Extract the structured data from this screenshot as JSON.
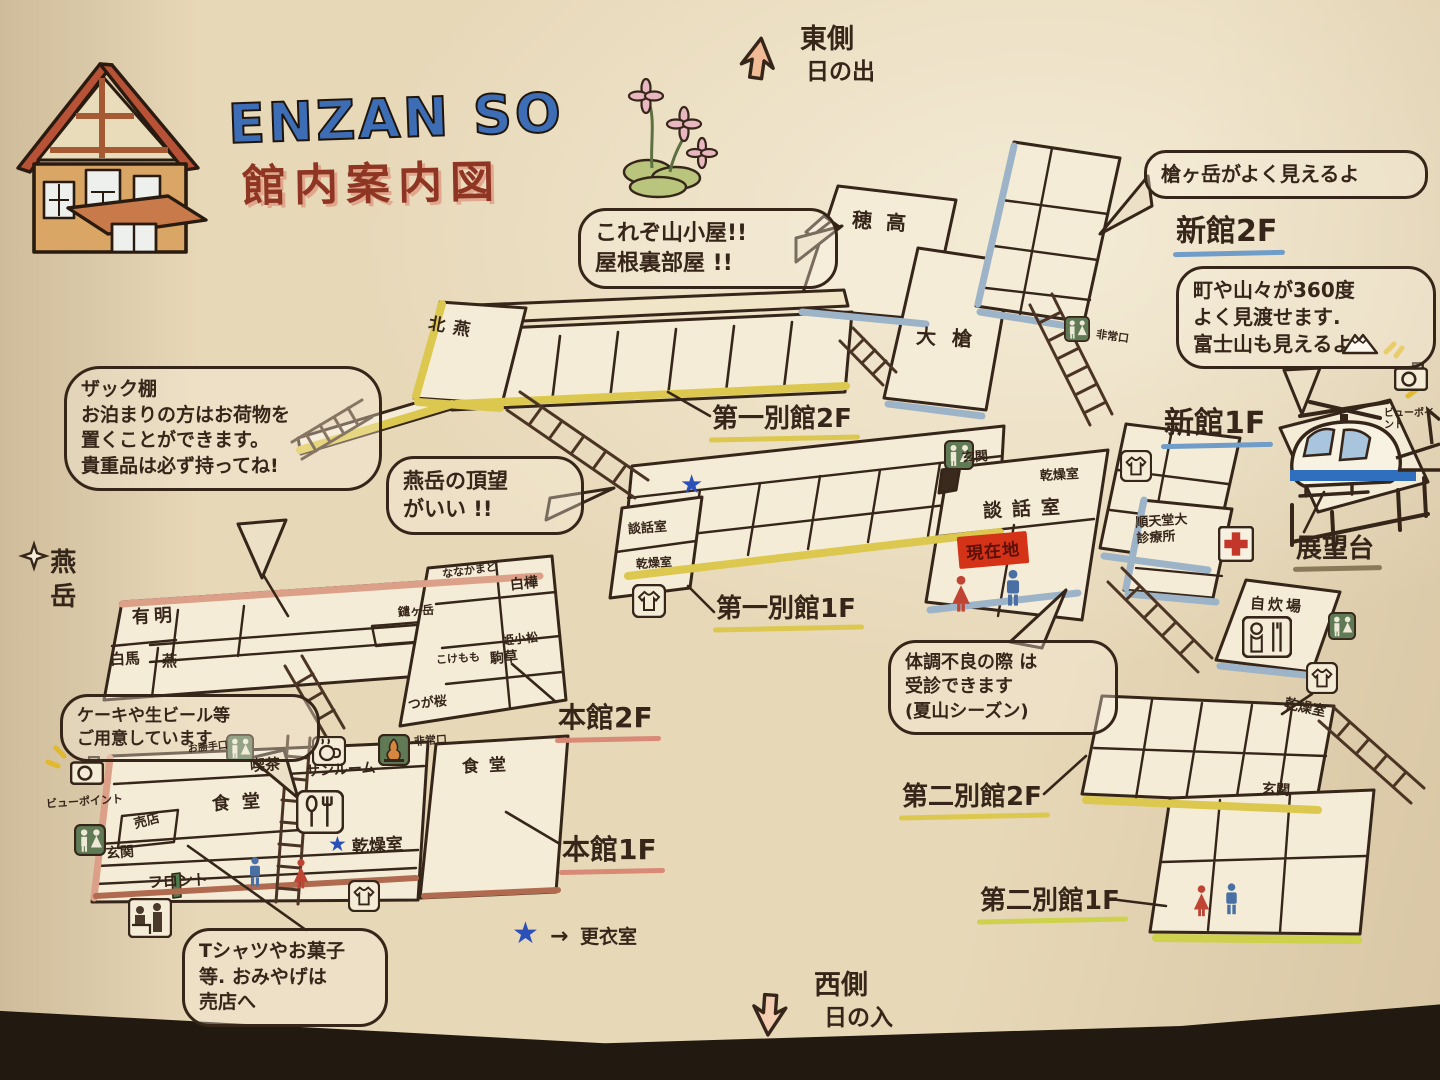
{
  "title": {
    "logo": "enzan so",
    "subtitle": "館内案内図"
  },
  "compass": {
    "east_line1": "東側",
    "east_line2": "日の出",
    "west_line1": "西側",
    "west_line2": "日の入"
  },
  "legend": {
    "star": "★",
    "arrow": "→",
    "text": "更衣室"
  },
  "mountain_left": "燕岳",
  "bubbles": {
    "attic": "これぞ山小屋!!\n屋根裏部屋 !!",
    "yari": "槍ヶ岳がよく見えるよ",
    "view360": "町や山々が360度\nよく見渡せます.\n富士山も見えるよ",
    "zakku": "ザック棚\nお泊まりの方はお荷物を\n置くことができます。\n貴重品は必ず持ってね!",
    "tsubakuro_view": "燕岳の頂望\nがいい !!",
    "cake": "ケーキや生ビール等\nご用意しています",
    "clinic": "体調不良の際 は\n受診できます\n(夏山シーズン)",
    "souvenir": "Tシャツやお菓子\n等. おみやげは\n売店へ"
  },
  "floors": {
    "shinkan_2f": "新館2F",
    "shinkan_1f": "新館1F",
    "daiichi_2f": "第一別館2F",
    "daiichi_1f": "第一別館1F",
    "honkan_2f": "本館2F",
    "honkan_1f": "本館1F",
    "daini_2f": "第二別館2F",
    "daini_1f": "第二別館1F",
    "tenbodai": "展望台"
  },
  "rooms": {
    "hotaka": "穂高",
    "oyari": "大槍",
    "kitatsubame": "北燕",
    "danwa_small": "談話室",
    "kanso_small": "乾燥室",
    "danwa_large": "談話室",
    "genkan_center": "玄関",
    "genzaichi": "現在地",
    "ariake": "有明",
    "hakuba": "白馬",
    "tsubame": "燕",
    "yarigatake": "鑓ヶ岳",
    "nanakamado": "ななかまど",
    "shirakaba": "白樺",
    "himekomatsu": "姫小松",
    "kokemomo": "こけもも",
    "komakusa": "駒草",
    "tsugazakura": "つが桜",
    "kissa": "喫茶",
    "sunroom": "サンルーム",
    "shokudo_left": "食堂",
    "shokudo_right": "食堂",
    "baiten": "売店",
    "genkan_left": "玄関",
    "front": "フロント",
    "kanso_honkan": "乾燥室",
    "kanso_shinkan": "乾燥室",
    "kanso_daini": "乾燥室",
    "hijoguchi_honkan": "非常口",
    "hijoguchi_oyari": "非常口",
    "katteguchi": "お勝手口",
    "juntendo": "順天堂大\n診療所",
    "jisuijo": "自炊場",
    "genkan_daini": "玄関",
    "viewpoint_left": "ビューポイント",
    "viewpoint_right": "ビューポイント"
  },
  "icons": {
    "wc-icon": "restroom pictogram (green box)",
    "tshirt-icon": "drying-room shirt pictogram",
    "redcross-icon": "first-aid cross",
    "camera-icon": "photo viewpoint camera",
    "cutlery-icon": "dining fork & spoon",
    "coffee-icon": "cafe cup",
    "stove-icon": "stove",
    "reception-icon": "front desk figures",
    "cook-icon": "self-cooking area",
    "helicopter-icon": "helicopter on deck",
    "fuji-icon": "Mt. Fuji",
    "flower-icon": "alpine flowers",
    "house-icon": "lodge illustration",
    "compass-arrow-icon": "direction arrow",
    "sparkle-icon": "sparkle star"
  },
  "colors": {
    "paper": "#e7d8b8",
    "ink": "#36261a",
    "logo_blue": "#3c6db5",
    "title_red": "#8e3524",
    "underline_yellow": "#dcc84e",
    "underline_blue": "#6f9cc8",
    "underline_red": "#d98a77",
    "arrow_fill": "#f2bb97",
    "current_location_red": "#d43318",
    "wc_green": "#5f7a55",
    "star_blue": "#2b50b8"
  }
}
